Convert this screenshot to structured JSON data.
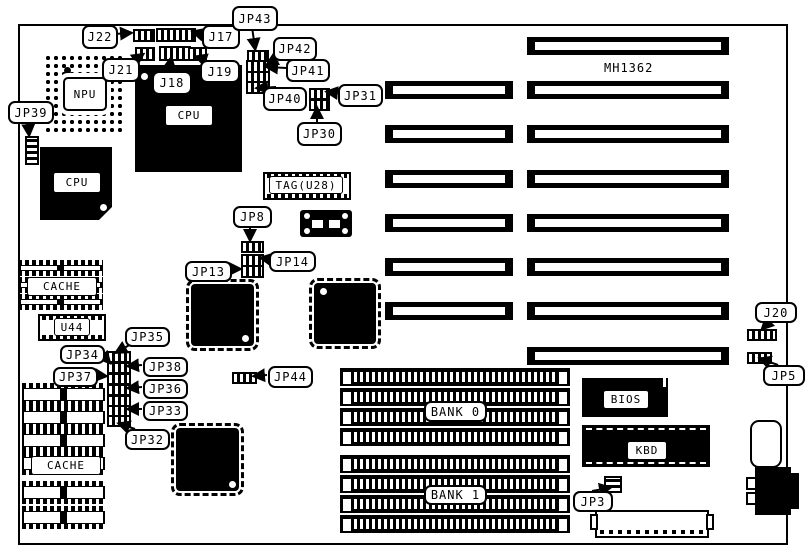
{
  "board": {
    "part_number": "MH1362"
  },
  "labels": {
    "j22": "J22",
    "j17": "J17",
    "jp43": "JP43",
    "j21": "J21",
    "j18": "J18",
    "j19": "J19",
    "jp42": "JP42",
    "jp41": "JP41",
    "jp40": "JP40",
    "jp31": "JP31",
    "jp30": "JP30",
    "jp39": "JP39",
    "jp8": "JP8",
    "jp13": "JP13",
    "jp14": "JP14",
    "jp35": "JP35",
    "jp34": "JP34",
    "jp38": "JP38",
    "jp37": "JP37",
    "jp36": "JP36",
    "jp33": "JP33",
    "jp32": "JP32",
    "jp44": "JP44",
    "jp3": "JP3",
    "j20": "J20",
    "jp5": "JP5",
    "npu": "NPU",
    "cpu_socketed": "CPU",
    "cpu_onboard": "CPU",
    "tag_ram": "TAG(U28)",
    "cache_upper": "CACHE",
    "cache_lower": "CACHE",
    "u44": "U44",
    "bank0": "BANK 0",
    "bank1": "BANK 1",
    "bios": "BIOS",
    "kbd": "KBD"
  }
}
